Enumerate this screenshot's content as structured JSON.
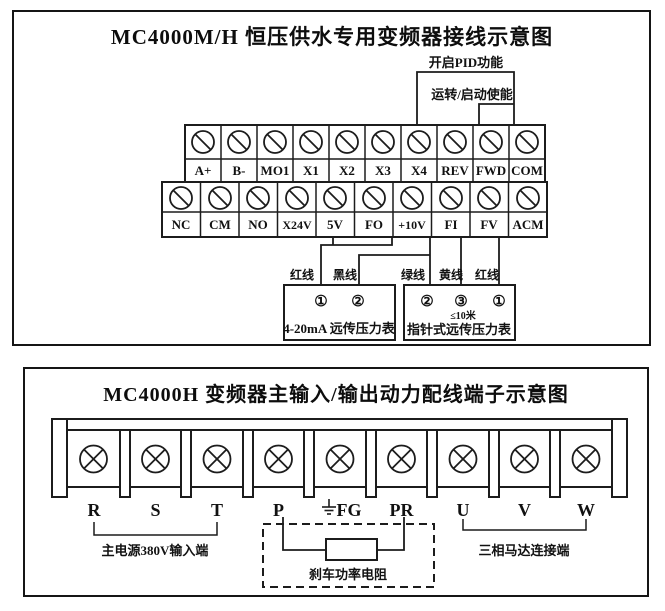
{
  "top": {
    "title": "MC4000M/H 恒压供水专用变频器接线示意图",
    "pid_enable_label": "开启PID功能",
    "run_enable_label": "运转/启动使能",
    "upper_terminals": [
      "A+",
      "B-",
      "MO1",
      "X1",
      "X2",
      "X3",
      "X4",
      "REV",
      "FWD",
      "COM"
    ],
    "lower_terminals": [
      "NC",
      "CM",
      "NO",
      "X24V",
      "5V",
      "FO",
      "+10V",
      "FI",
      "FV",
      "ACM"
    ],
    "wire_labels": [
      "红线",
      "黑线",
      "绿线",
      "黄线",
      "红线"
    ],
    "gauge_420ma": {
      "label": "4-20mA 远传压力表",
      "terminals": [
        "①",
        "②"
      ]
    },
    "gauge_pointer": {
      "label": "指针式远传压力表",
      "terminals": [
        "②",
        "③",
        "①"
      ],
      "cable_note": "≤10米"
    }
  },
  "bottom": {
    "title": "MC4000H 变频器主输入/输出动力配线端子示意图",
    "terminals": [
      "R",
      "S",
      "T",
      "P",
      "FG",
      "PR",
      "U",
      "V",
      "W"
    ],
    "power_input_label": "主电源380V输入端",
    "brake_resistor_label": "刹车功率电阻",
    "motor_label": "三相马达连接端"
  }
}
